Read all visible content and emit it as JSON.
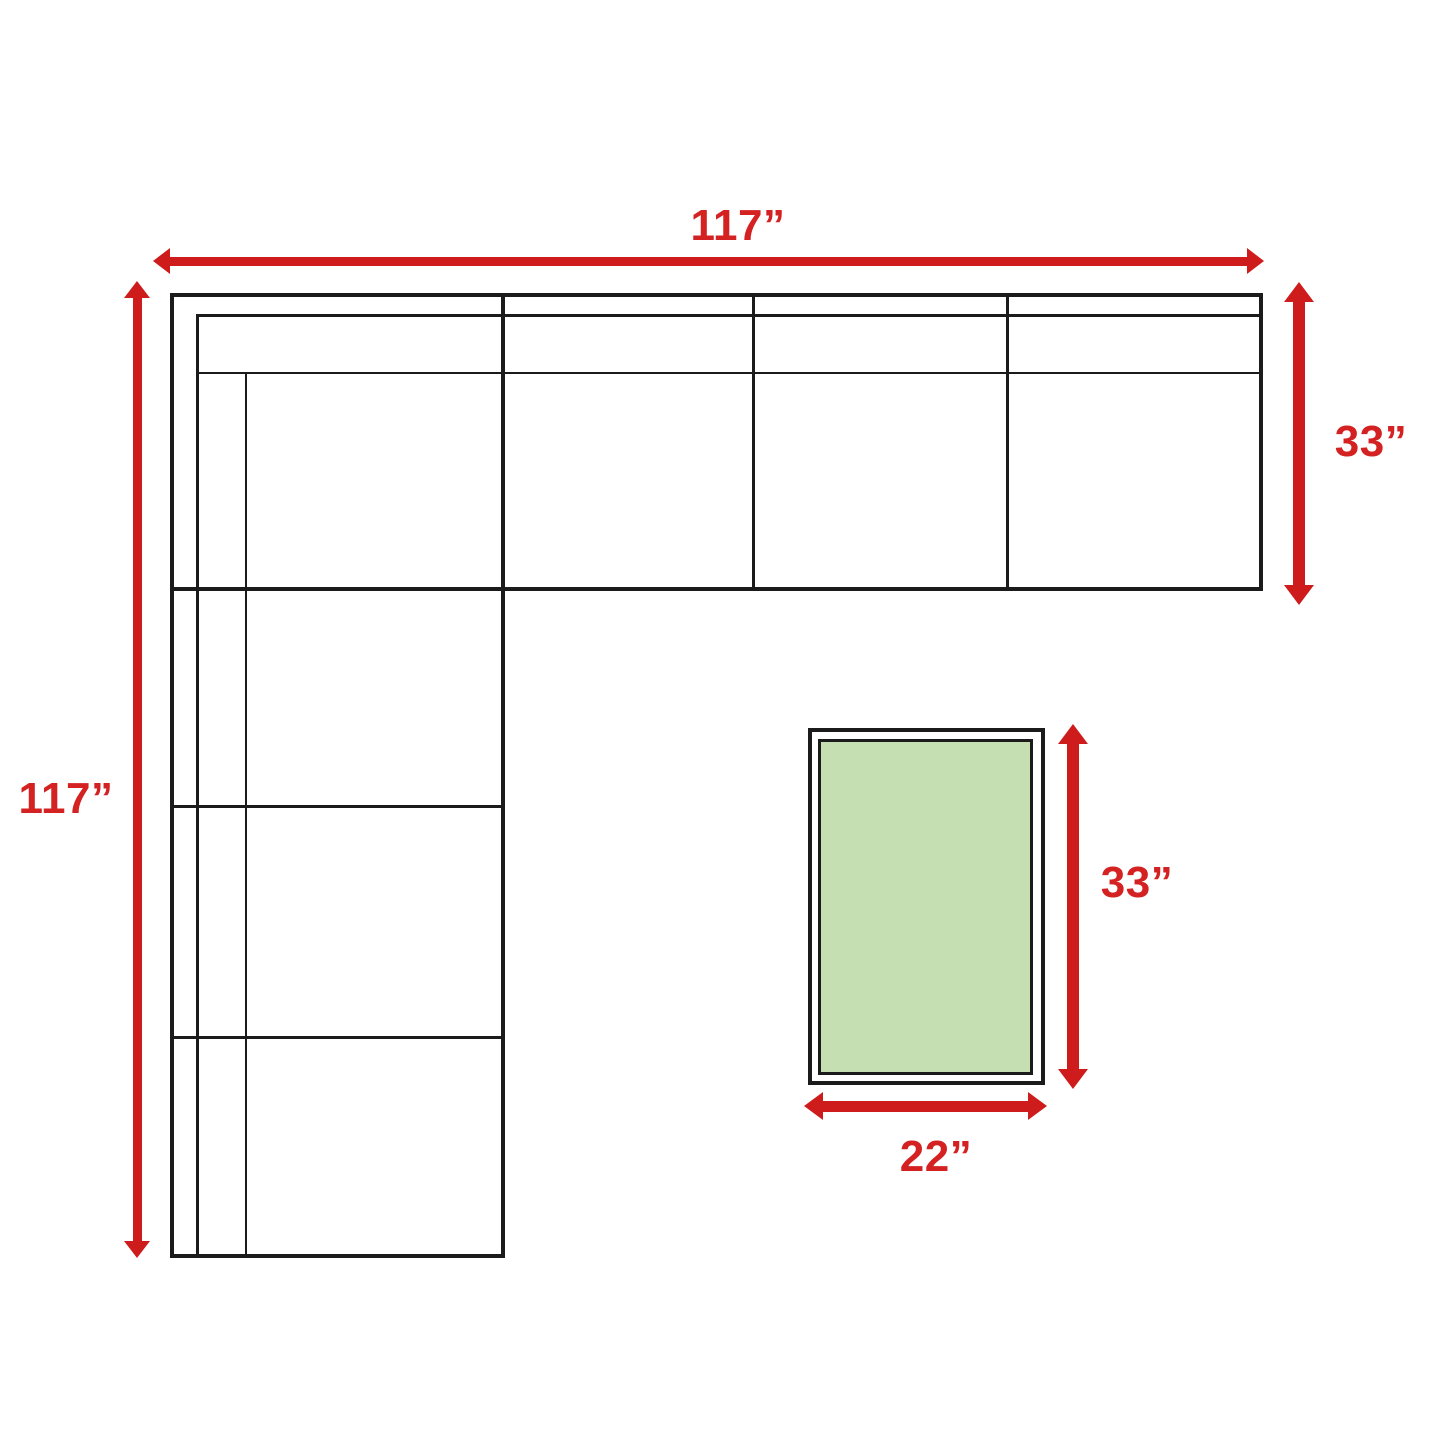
{
  "diagram": {
    "title": "sectional-sofa-dimension-diagram",
    "colors": {
      "background": "#ffffff",
      "outline": "#1b1b1b",
      "dimension_red": "#ce1c1c",
      "label_red": "#d42121",
      "table_fill": "#c5dfb3"
    },
    "sofa": {
      "width_label": "117”",
      "depth_label": "117”",
      "side_depth_label": "33”"
    },
    "table": {
      "height_label": "33”",
      "width_label": "22”"
    }
  }
}
